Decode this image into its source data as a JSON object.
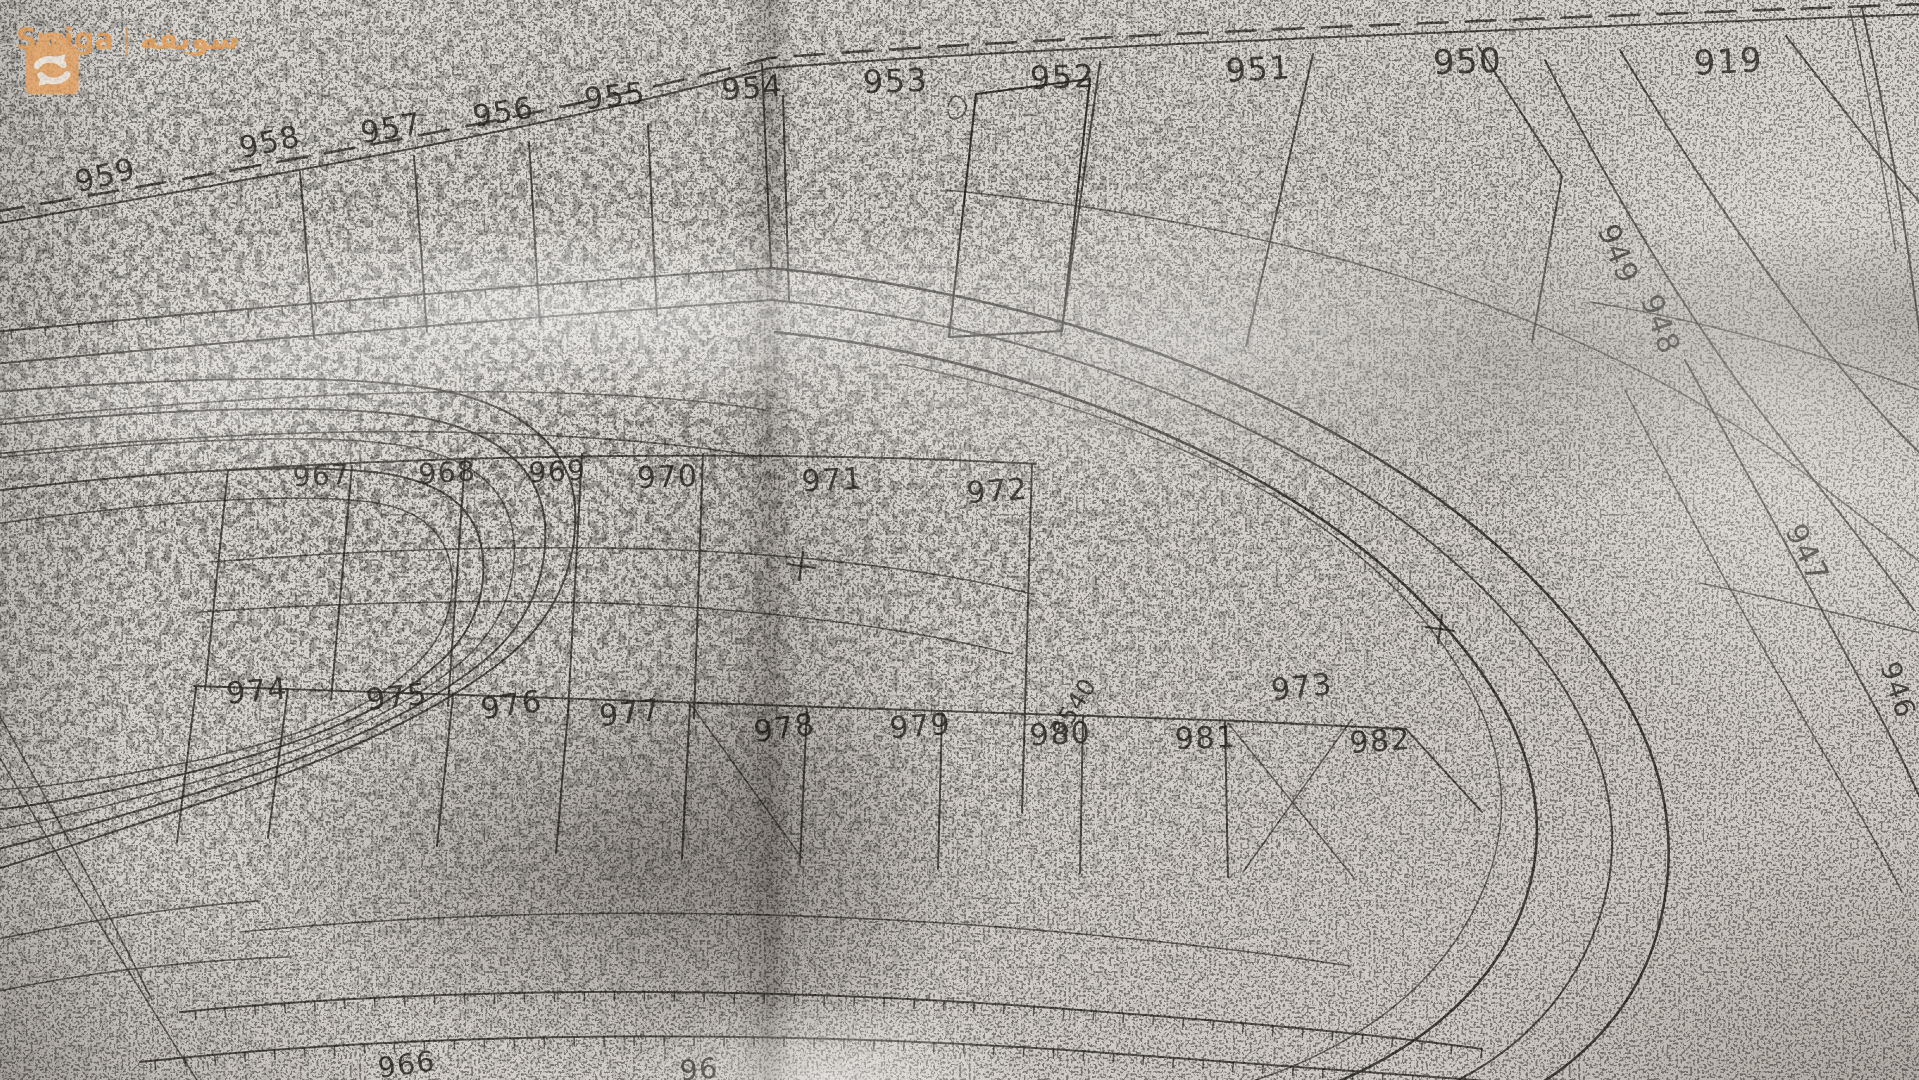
{
  "watermark": {
    "brand": "Swiga",
    "separator": "|",
    "brand_arabic": "سويقة",
    "color": "#e59d55",
    "icon": "shopping-bag-icon"
  },
  "map": {
    "kind": "photocopied cadastral survey plan",
    "ink_color": "#34312c",
    "paper_color": "#d8d4ce",
    "plot_labels": [
      {
        "text": "959",
        "x": 108,
        "y": 185,
        "r": -14,
        "s": 30
      },
      {
        "text": "958",
        "x": 272,
        "y": 152,
        "r": -12,
        "s": 30
      },
      {
        "text": "957",
        "x": 393,
        "y": 138,
        "r": -10,
        "s": 30
      },
      {
        "text": "956",
        "x": 505,
        "y": 122,
        "r": -9,
        "s": 30
      },
      {
        "text": "955",
        "x": 616,
        "y": 106,
        "r": -6,
        "s": 30
      },
      {
        "text": "954",
        "x": 753,
        "y": 98,
        "r": -4,
        "s": 30
      },
      {
        "text": "953",
        "x": 896,
        "y": 92,
        "r": -2,
        "s": 32
      },
      {
        "text": "952",
        "x": 1063,
        "y": 88,
        "r": -2,
        "s": 32
      },
      {
        "text": "951",
        "x": 1259,
        "y": 80,
        "r": -3,
        "s": 32
      },
      {
        "text": "950",
        "x": 1468,
        "y": 73,
        "r": -2,
        "s": 34
      },
      {
        "text": "919",
        "x": 1729,
        "y": 73,
        "r": -3,
        "s": 34
      },
      {
        "text": "967",
        "x": 322,
        "y": 485,
        "r": -3,
        "s": 28
      },
      {
        "text": "968",
        "x": 448,
        "y": 482,
        "r": -4,
        "s": 28
      },
      {
        "text": "969",
        "x": 558,
        "y": 481,
        "r": -3,
        "s": 28
      },
      {
        "text": "970",
        "x": 668,
        "y": 487,
        "r": -2,
        "s": 30
      },
      {
        "text": "971",
        "x": 833,
        "y": 490,
        "r": -3,
        "s": 30
      },
      {
        "text": "972",
        "x": 998,
        "y": 501,
        "r": -4,
        "s": 30
      },
      {
        "text": "973",
        "x": 1303,
        "y": 697,
        "r": -6,
        "s": 30
      },
      {
        "text": "974",
        "x": 258,
        "y": 701,
        "r": -5,
        "s": 30
      },
      {
        "text": "975",
        "x": 398,
        "y": 707,
        "r": -6,
        "s": 30
      },
      {
        "text": "976",
        "x": 513,
        "y": 715,
        "r": -8,
        "s": 30
      },
      {
        "text": "977",
        "x": 631,
        "y": 723,
        "r": -6,
        "s": 30
      },
      {
        "text": "978",
        "x": 786,
        "y": 738,
        "r": -8,
        "s": 30
      },
      {
        "text": "979",
        "x": 921,
        "y": 736,
        "r": -4,
        "s": 30
      },
      {
        "text": "980",
        "x": 1061,
        "y": 744,
        "r": -3,
        "s": 30
      },
      {
        "text": "981",
        "x": 1206,
        "y": 748,
        "r": -2,
        "s": 30
      },
      {
        "text": "982",
        "x": 1381,
        "y": 751,
        "r": -4,
        "s": 30
      },
      {
        "text": "949",
        "x": 1609,
        "y": 258,
        "r": 68,
        "s": 30
      },
      {
        "text": "948",
        "x": 1651,
        "y": 328,
        "r": 70,
        "s": 30
      },
      {
        "text": "947",
        "x": 1798,
        "y": 558,
        "r": 64,
        "s": 30
      },
      {
        "text": "946",
        "x": 1889,
        "y": 693,
        "r": 72,
        "s": 28
      },
      {
        "text": "966",
        "x": 408,
        "y": 1074,
        "r": -8,
        "s": 28
      },
      {
        "text": "96",
        "x": 700,
        "y": 1079,
        "r": -5,
        "s": 28
      }
    ],
    "annotations": [
      {
        "text": "3540",
        "x": 1080,
        "y": 712,
        "r": -58,
        "s": 24
      }
    ],
    "cross_marks": [
      {
        "x": 801,
        "y": 566
      },
      {
        "x": 1440,
        "y": 629
      }
    ]
  }
}
